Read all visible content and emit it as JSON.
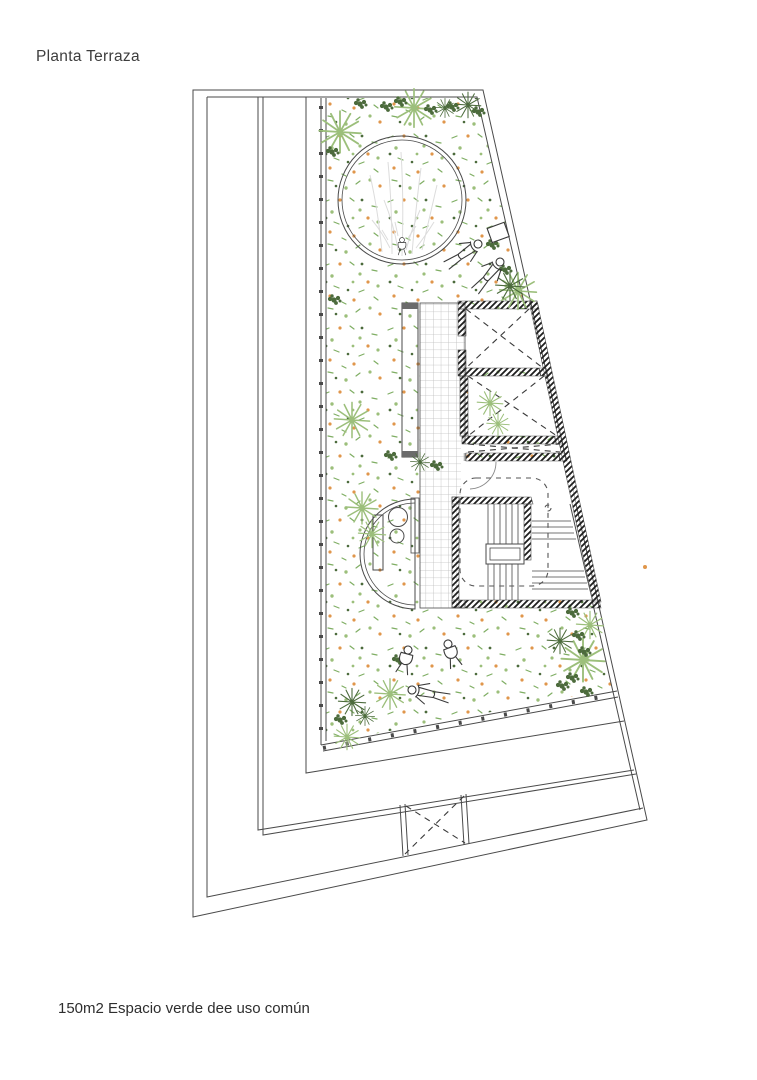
{
  "header": {
    "title": "Planta Terraza"
  },
  "footer": {
    "caption": "150m2 Espacio verde  dee uso común"
  },
  "palette": {
    "line": "#4a4a4a",
    "wall": "#1e1e1e",
    "light-green": "#9cbf7b",
    "mid-green": "#7fae63",
    "dark-green": "#4c6b3c",
    "orange": "#e0964b",
    "tile": "#bdbdbd",
    "sketch": "#dcdcdc",
    "figure": "#3a3a3a"
  }
}
